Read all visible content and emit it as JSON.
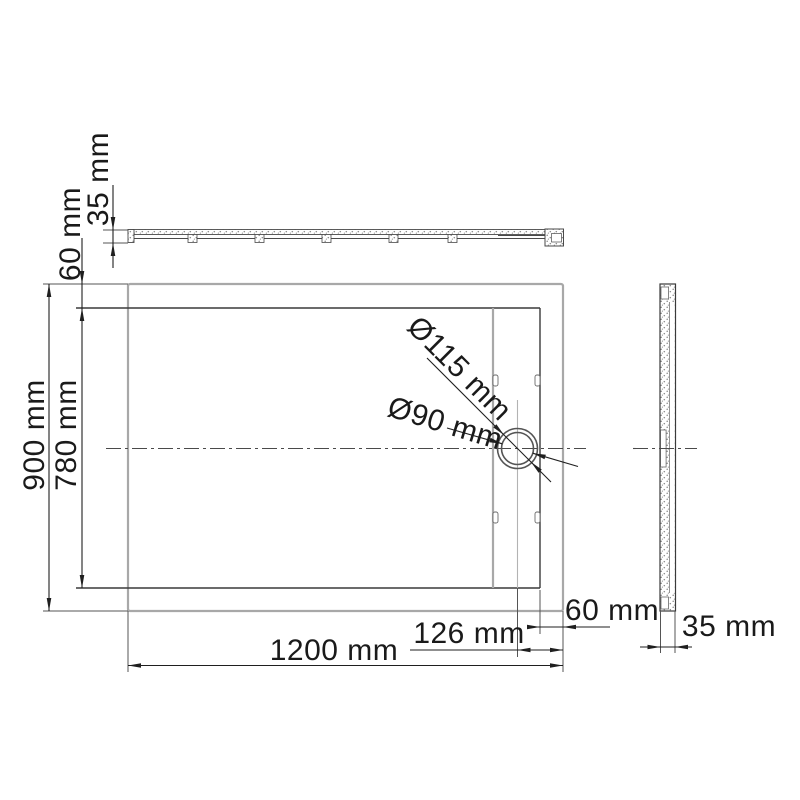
{
  "drawing": {
    "title": "shower-tray dimension drawing",
    "labels": {
      "top_section_thickness": "35 mm",
      "top_rim": "60 mm",
      "outer_height": "900 mm",
      "inner_height": "780 mm",
      "drain_outer_diameter": "Ø115 mm",
      "drain_inner_diameter": "Ø90 mm",
      "outer_width": "1200 mm",
      "drain_offset_from_right": "126 mm",
      "right_rim": "60 mm",
      "side_section_thickness": "35 mm"
    },
    "colors": {
      "background": "#ffffff",
      "outline_gray": "#a8a8a8",
      "line_dark": "#333333",
      "dimension": "#1f1f1f",
      "stipple": "#8a8a8a",
      "text": "#1a1a1a"
    }
  }
}
